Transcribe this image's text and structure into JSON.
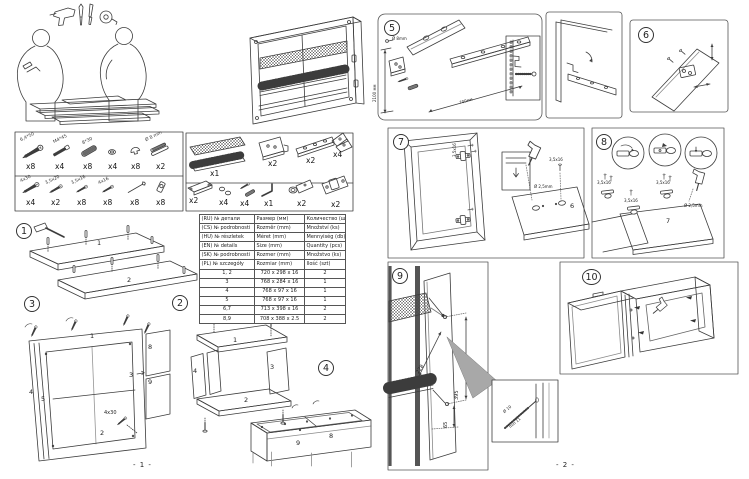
{
  "page": {
    "footer_left": "- 1 -",
    "footer_right": "- 2 -"
  },
  "hardware": {
    "box1_row1": [
      {
        "item": "wood-screw-6-4x50",
        "label": "6,4*50",
        "qty": "x8"
      },
      {
        "item": "bolt-m4x45",
        "label": "M4*45",
        "qty": "x4"
      },
      {
        "item": "dowel-8x30",
        "label": "8*30",
        "qty": "x8"
      },
      {
        "item": "cover-cap",
        "label": "",
        "qty": "x4"
      },
      {
        "item": "screw-cover",
        "label": "",
        "qty": "x8"
      },
      {
        "item": "pin-8mm",
        "label": "Ø 8 mm",
        "qty": "x2"
      }
    ],
    "box1_row2": [
      {
        "item": "screw-4x30",
        "label": "4x30",
        "qty": "x4"
      },
      {
        "item": "screw-3-5x20",
        "label": "3,5x20",
        "qty": "x2"
      },
      {
        "item": "screw-3-5x16",
        "label": "3,5x16",
        "qty": "x8"
      },
      {
        "item": "screw-4x16",
        "label": "4x16",
        "qty": "x8"
      },
      {
        "item": "nail",
        "label": "",
        "qty": "x8"
      },
      {
        "item": "connector",
        "label": "",
        "qty": "x8"
      }
    ],
    "box2_row1": [
      {
        "item": "dish-rack-set",
        "qty": "x1"
      },
      {
        "item": "hanging-bracket",
        "qty": "x2"
      },
      {
        "item": "wall-rail",
        "qty": "x2"
      },
      {
        "item": "corner-brace",
        "qty": "x4"
      }
    ],
    "box2_row2": [
      {
        "item": "drip-tray",
        "qty": "x2"
      },
      {
        "item": "cap",
        "qty": "x4"
      },
      {
        "item": "wall-plug-set",
        "qty": "x4"
      },
      {
        "item": "allen-key",
        "qty": "x1"
      },
      {
        "item": "hinge",
        "qty": "x2"
      },
      {
        "item": "hinge-plate",
        "qty": "x2"
      }
    ]
  },
  "parts_table": {
    "headers": [
      {
        "lang": "(RU)",
        "no": "№ детали",
        "size": "Размер (мм)",
        "qty": "Количество (шт)"
      },
      {
        "lang": "(CS)",
        "no": "№ podrobnosti",
        "size": "Rozměr (mm)",
        "qty": "Množství (ks)"
      },
      {
        "lang": "(HU)",
        "no": "№ részletek",
        "size": "Méret (mm)",
        "qty": "Mennyiség (db)"
      },
      {
        "lang": "(EN)",
        "no": "№ details",
        "size": "Size (mm)",
        "qty": "Quantity (pcs)"
      },
      {
        "lang": "(SK)",
        "no": "№ podrobnosti",
        "size": "Rozmer (mm)",
        "qty": "Množstvo (ks)"
      },
      {
        "lang": "(PL)",
        "no": "№ szczegóły",
        "size": "Rozmiar (mm)",
        "qty": "Ilość (szt)"
      }
    ],
    "rows": [
      {
        "no": "1, 2",
        "size": "720 x 298 x 16",
        "qty": "2"
      },
      {
        "no": "3",
        "size": "768 x 284 x 16",
        "qty": "1"
      },
      {
        "no": "4",
        "size": "768 x 97 x 16",
        "qty": "1"
      },
      {
        "no": "5",
        "size": "768 x 97 x 16",
        "qty": "1"
      },
      {
        "no": "6,7",
        "size": "713 x 398 x 16",
        "qty": "2"
      },
      {
        "no": "8,9",
        "size": "708 x 388 x 2.5",
        "qty": "2"
      }
    ]
  },
  "step_numbers": {
    "s1": "1",
    "s2": "2",
    "s3": "3",
    "s4": "4",
    "s5": "5",
    "s6": "6",
    "s7": "7",
    "s8": "8",
    "s9": "9",
    "s10": "10"
  },
  "step1": {
    "part1": "1",
    "part2": "2"
  },
  "step2": {
    "part1": "1",
    "part2": "2",
    "part3": "3",
    "part4": "4"
  },
  "step3": {
    "part1": "1",
    "part2": "2",
    "part3": "3",
    "part4": "4",
    "part5": "5",
    "part8": "8",
    "part9": "9",
    "screw": "4x30"
  },
  "step4": {
    "part8": "8",
    "part9": "9"
  },
  "step5": {
    "drill_dia": "Ø 8mm",
    "wall_height": "2100 мм",
    "spacing": "700мм"
  },
  "step7": {
    "screw_side": "3,5x16",
    "screw_door": "3,5x16",
    "part6": "6",
    "predrill": "Ø 2,5mm"
  },
  "step8": {
    "screw1": "3,5x16",
    "screw2": "3,5x16",
    "screw3": "3,5x16",
    "part7": "7",
    "predrill": "Ø 2,5mm"
  },
  "step9": {
    "dim_depth": "228",
    "dim_height": "395",
    "dim_bottom": "65",
    "drill_dia": "Ø 10",
    "drill_depth": "min 11"
  }
}
